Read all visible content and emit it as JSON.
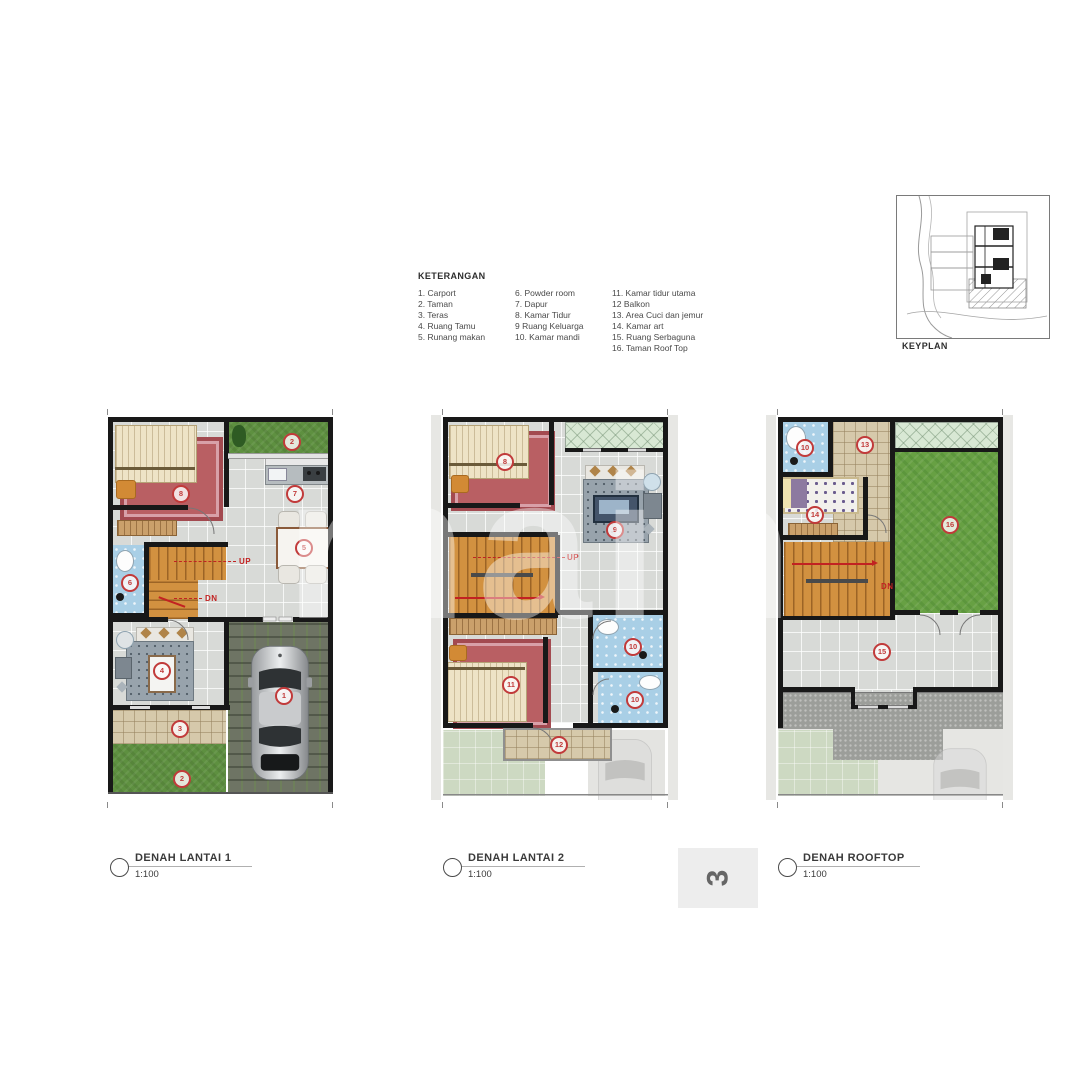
{
  "legend": {
    "title": "KETERANGAN",
    "col1": [
      "1. Carport",
      "2. Taman",
      "3. Teras",
      "4. Ruang Tamu",
      "5. Runang makan"
    ],
    "col2": [
      "6. Powder room",
      "7. Dapur",
      "8. Kamar Tidur",
      "9 Ruang Keluarga",
      "10. Kamar mandi"
    ],
    "col3": [
      "11. Kamar tidur utama",
      "12 Balkon",
      "13. Area Cuci dan jemur",
      "14. Kamar art",
      "15. Ruang Serbaguna",
      "16. Taman Roof Top"
    ]
  },
  "keyplan": {
    "label": "KEYPLAN"
  },
  "watermark": "main",
  "page_number": "3",
  "plans": [
    {
      "title": "DENAH LANTAI 1",
      "scale": "1:100",
      "up": "UP",
      "dn": "DN",
      "badges": [
        "8",
        "2",
        "7",
        "5",
        "6",
        "4",
        "3",
        "2",
        "1"
      ]
    },
    {
      "title": "DENAH LANTAI 2",
      "scale": "1:100",
      "up": "UP",
      "badges": [
        "8",
        "9",
        "11",
        "10",
        "10",
        "12"
      ]
    },
    {
      "title": "DENAH ROOFTOP",
      "scale": "1:100",
      "dn": "DN",
      "badges": [
        "10",
        "13",
        "16",
        "14",
        "15"
      ]
    }
  ],
  "colors": {
    "badge": "#c13a3a",
    "wall": "#181818",
    "grass": "#5e9040",
    "stairs": "#d29140",
    "bath": "#a9cfe6"
  }
}
